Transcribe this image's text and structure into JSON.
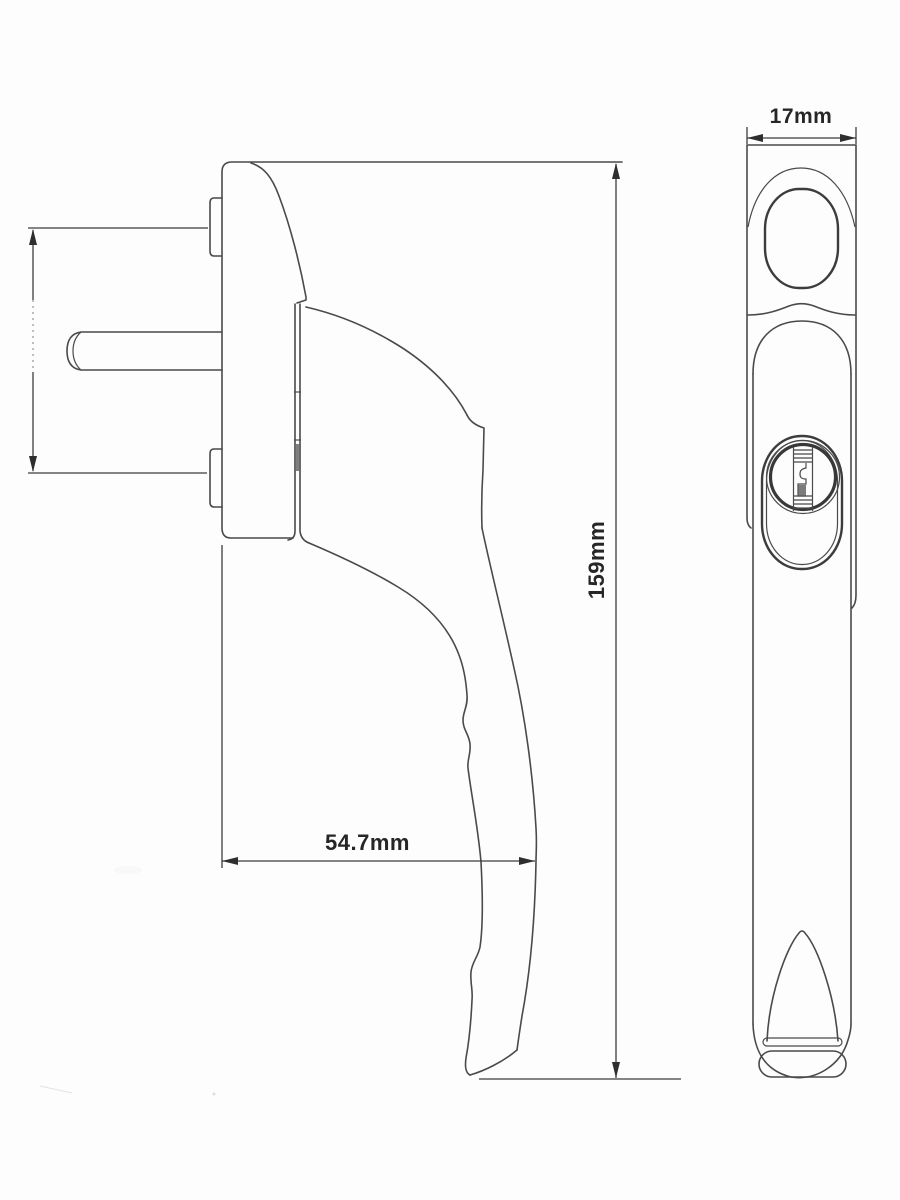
{
  "drawing": {
    "kind": "technical-line-drawing",
    "background": "#fdfdfd",
    "line_color": "#4a4a4a",
    "views": {
      "side": {
        "name": "side-profile-view"
      },
      "front": {
        "name": "front-view"
      }
    },
    "dimensions": {
      "width": {
        "label": "17mm",
        "orientation": "horizontal"
      },
      "height": {
        "label": "159mm",
        "orientation": "vertical"
      },
      "depth": {
        "label": "54.7mm",
        "orientation": "horizontal"
      },
      "fixing_centres": {
        "label": "",
        "orientation": "vertical"
      }
    }
  }
}
